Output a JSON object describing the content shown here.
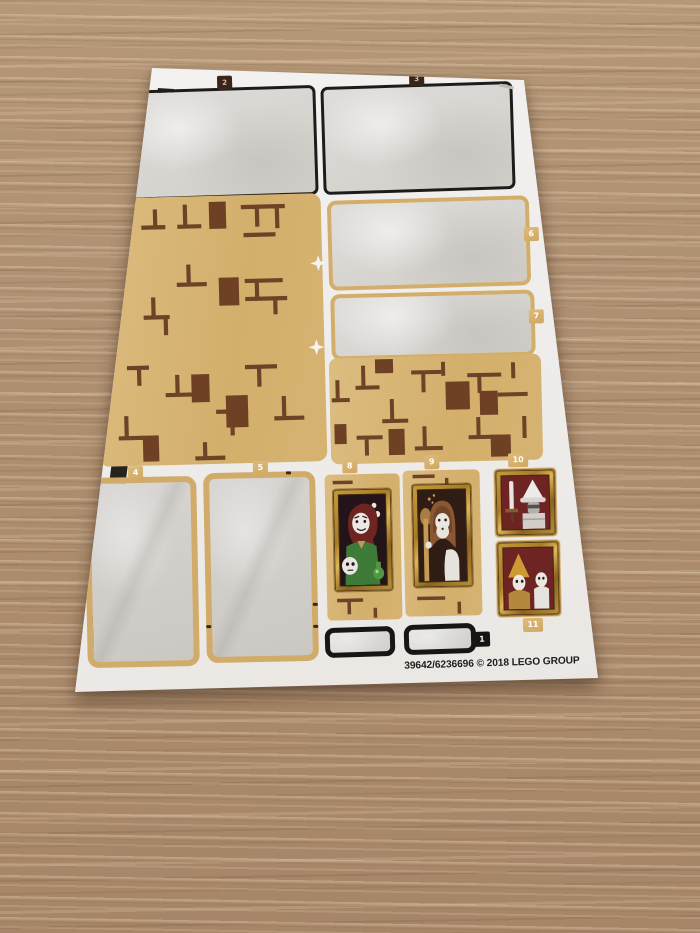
{
  "sheet": {
    "footer_text": "39642/6236696 © 2018 LEGO GROUP",
    "tab_labels": {
      "t1": "1",
      "t2": "2",
      "t3": "3",
      "t4": "4",
      "t5": "5",
      "t6": "6",
      "t7": "7",
      "t8": "8",
      "t9": "9",
      "t10": "10",
      "t11": "11"
    }
  },
  "colors": {
    "wood_base": "#b29070",
    "sheet_white": "#f0efec",
    "parchment": "#d9d7d3",
    "tan_sticker": "#d7b478",
    "brick_brown": "#6d4226",
    "frame_gold": "#c79b3c",
    "portrait_bg_dark": "#281419",
    "portrait_bg_red": "#6e2423",
    "strip_black": "#1f1c18",
    "tab_tan": "#d4b172",
    "border_black": "#1c1c1c"
  }
}
